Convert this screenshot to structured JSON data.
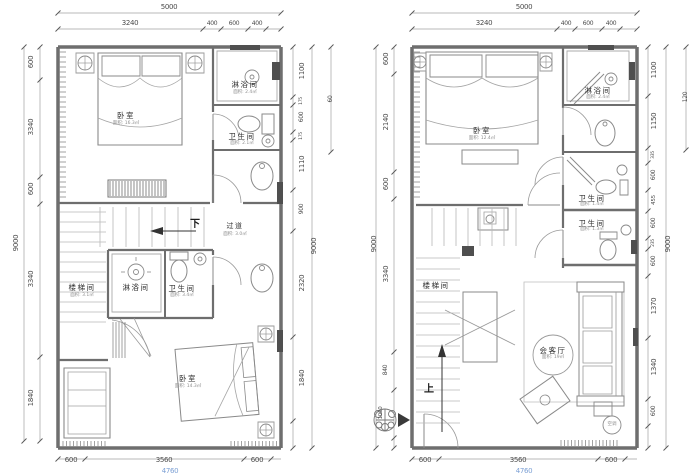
{
  "plans": {
    "left": {
      "dims": {
        "top_total": "5000",
        "top_segments": [
          "3240",
          "400",
          "600",
          "400"
        ],
        "left_segments": [
          "600",
          "3340",
          "600",
          "3340",
          "1840"
        ],
        "left_total": "9000",
        "right_segments": [
          "1100",
          "175",
          "600",
          "175",
          "1110",
          "900",
          "2320",
          "1840"
        ],
        "right_total": "9000",
        "right_extra": "60",
        "bottom_segments": [
          "600",
          "3560",
          "600"
        ],
        "bottom_total": "4760"
      },
      "rooms": [
        {
          "label": "卧室",
          "area": "面积: 16.3㎡"
        },
        {
          "label": "淋浴间",
          "area": "面积: 2.4㎡"
        },
        {
          "label": "卫生间",
          "area": "面积: 2.1㎡"
        },
        {
          "label": "过道",
          "area": "面积: 3.0㎡"
        },
        {
          "label": "楼梯间",
          "area": "面积: 3.1㎡"
        },
        {
          "label": "淋浴间",
          "area": ""
        },
        {
          "label": "卫生间",
          "area": "面积: 3.4㎡"
        },
        {
          "label": "卧室",
          "area": "面积: 14.3㎡"
        }
      ],
      "annotations": {
        "down": "下"
      }
    },
    "right": {
      "dims": {
        "top_total": "5000",
        "top_segments": [
          "3240",
          "400",
          "600",
          "400"
        ],
        "left_segments": [
          "600",
          "2140",
          "600",
          "3340",
          "840",
          "1060"
        ],
        "left_total": "9000",
        "right_segments": [
          "1100",
          "1150",
          "335",
          "600",
          "455",
          "600",
          "235",
          "600",
          "1370",
          "1340",
          "600"
        ],
        "right_total": "9000",
        "right_extra": "120",
        "bottom_segments": [
          "600",
          "3560",
          "600"
        ],
        "bottom_total": "4760"
      },
      "rooms": [
        {
          "label": "卧室",
          "area": "面积: 12.4㎡"
        },
        {
          "label": "淋浴间",
          "area": "面积: 2.4㎡"
        },
        {
          "label": "卫生间",
          "area": "面积: 1.4㎡"
        },
        {
          "label": "卫生间",
          "area": "面积: 1.3㎡"
        },
        {
          "label": "楼梯间",
          "area": ""
        },
        {
          "label": "会客厅",
          "area": "面积: 19㎡"
        }
      ],
      "annotations": {
        "up": "上",
        "ac": "空调"
      }
    }
  }
}
